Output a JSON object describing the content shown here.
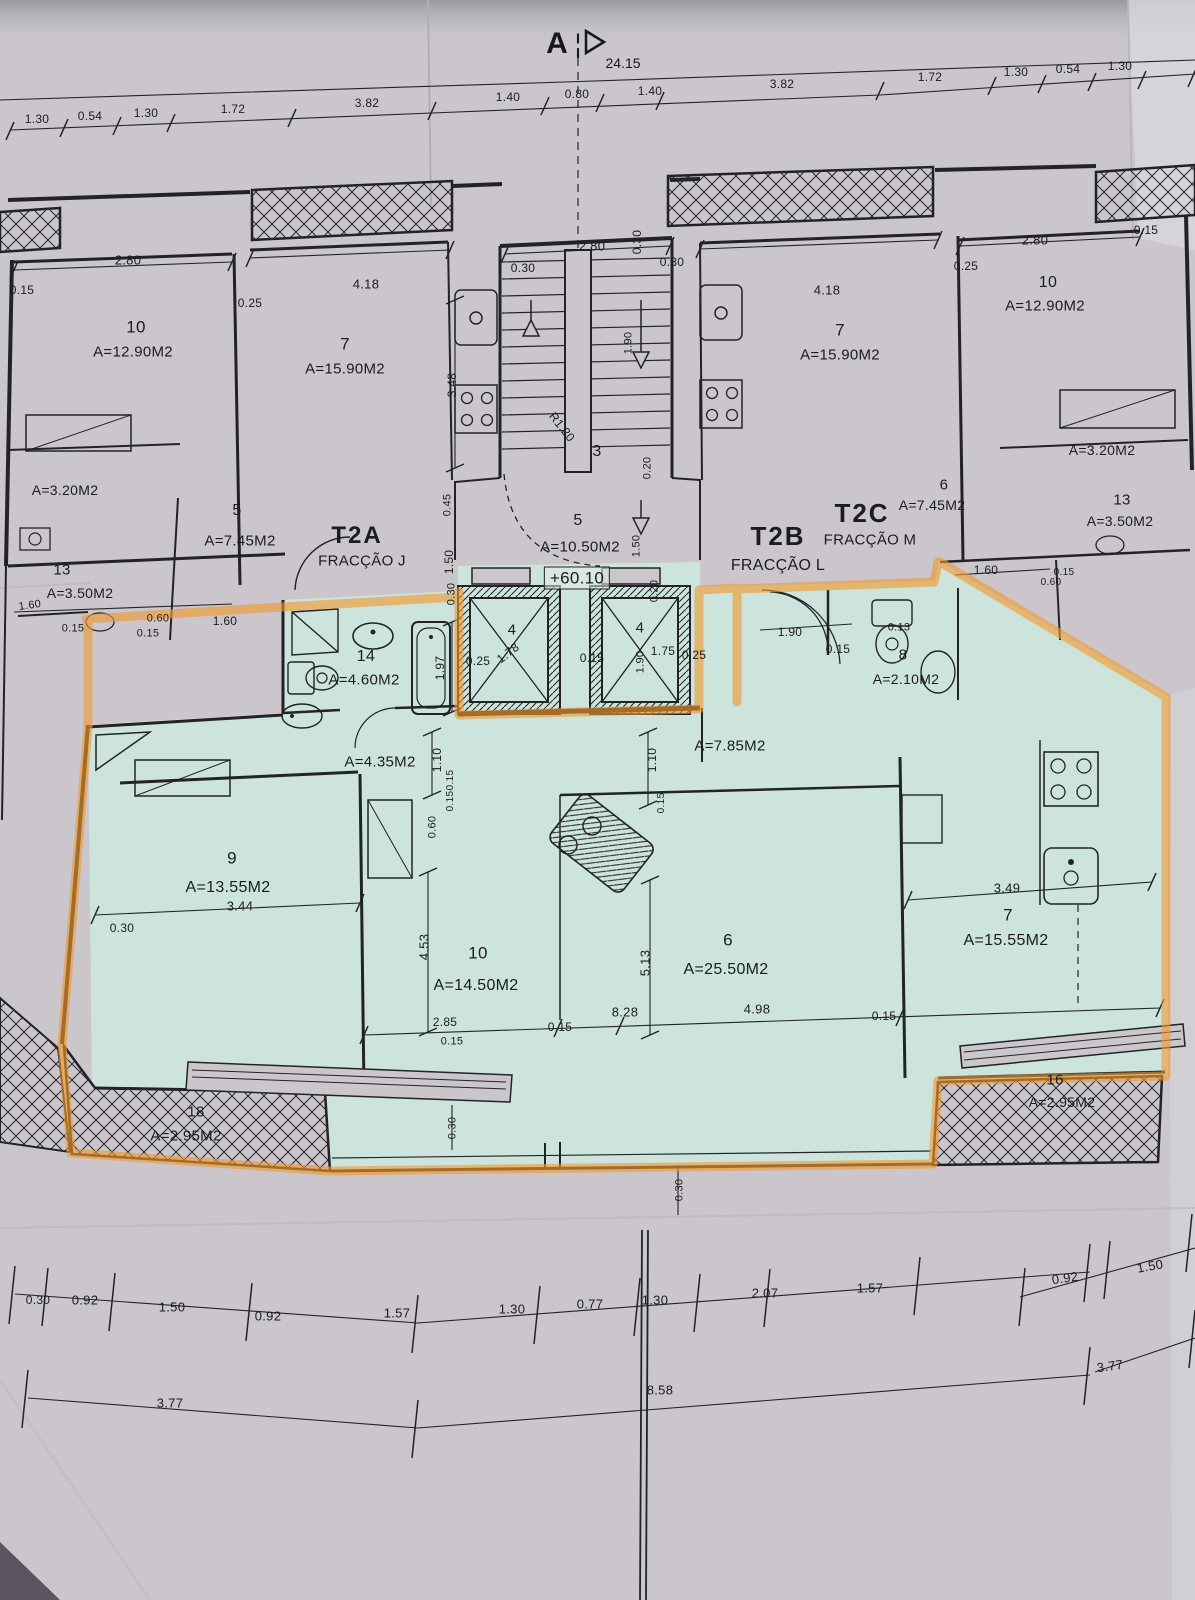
{
  "plan": {
    "section_marker": "A",
    "overall_dimension": "24.15",
    "level_mark": "+60.10",
    "fractions": [
      {
        "code": "T2A",
        "label": "FRACÇÃO J"
      },
      {
        "code": "T2B",
        "label": "FRACÇÃO L"
      },
      {
        "code": "T2C",
        "label": "FRACÇÃO M"
      }
    ],
    "colors": {
      "paper": "#cac6cc",
      "highlight_fill": "#cde4dc",
      "highlighter_orange": "#f0992f",
      "ink": "#232327"
    },
    "labels": [
      {
        "t": "1.30",
        "x": 37,
        "y": 119,
        "s": 12
      },
      {
        "t": "0.54",
        "x": 90,
        "y": 116,
        "s": 12
      },
      {
        "t": "1.30",
        "x": 146,
        "y": 113,
        "s": 12
      },
      {
        "t": "1.72",
        "x": 233,
        "y": 109,
        "s": 12
      },
      {
        "t": "3.82",
        "x": 367,
        "y": 103,
        "s": 12
      },
      {
        "t": "1.40",
        "x": 508,
        "y": 97,
        "s": 12
      },
      {
        "t": "0.80",
        "x": 577,
        "y": 94,
        "s": 12
      },
      {
        "t": "1.40",
        "x": 650,
        "y": 91,
        "s": 12
      },
      {
        "t": "3.82",
        "x": 782,
        "y": 84,
        "s": 12
      },
      {
        "t": "1.72",
        "x": 930,
        "y": 77,
        "s": 12
      },
      {
        "t": "1.30",
        "x": 1016,
        "y": 72,
        "s": 12
      },
      {
        "t": "0.54",
        "x": 1068,
        "y": 69,
        "s": 12
      },
      {
        "t": "1.30",
        "x": 1120,
        "y": 66,
        "s": 12
      },
      {
        "t": "0.15",
        "x": 22,
        "y": 290,
        "s": 12
      },
      {
        "t": "2.80",
        "x": 128,
        "y": 260,
        "s": 13
      },
      {
        "t": "10",
        "x": 136,
        "y": 327,
        "s": 17,
        "n": "room-number"
      },
      {
        "t": "A=12.90M2",
        "x": 133,
        "y": 352,
        "s": 15,
        "n": "room-area"
      },
      {
        "t": "0.25",
        "x": 250,
        "y": 303,
        "s": 12
      },
      {
        "t": "4.18",
        "x": 366,
        "y": 284,
        "s": 13
      },
      {
        "t": "7",
        "x": 345,
        "y": 344,
        "s": 17,
        "n": "room-number"
      },
      {
        "t": "A=15.90M2",
        "x": 345,
        "y": 369,
        "s": 15,
        "n": "room-area"
      },
      {
        "t": "3.48",
        "x": 452,
        "y": 385,
        "r": -90,
        "s": 12
      },
      {
        "t": "A=3.20M2",
        "x": 65,
        "y": 490,
        "s": 14,
        "n": "room-area"
      },
      {
        "t": "5",
        "x": 237,
        "y": 511,
        "s": 16,
        "n": "room-number"
      },
      {
        "t": "A=7.45M2",
        "x": 240,
        "y": 541,
        "s": 15,
        "n": "room-area"
      },
      {
        "t": "13",
        "x": 62,
        "y": 570,
        "s": 15,
        "n": "room-number"
      },
      {
        "t": "A=3.50M2",
        "x": 80,
        "y": 593,
        "s": 14,
        "n": "room-area"
      },
      {
        "t": "1.60",
        "x": 30,
        "y": 606,
        "s": 11,
        "r": -8
      },
      {
        "t": "0.60",
        "x": 158,
        "y": 619,
        "s": 11
      },
      {
        "t": "0.15",
        "x": 148,
        "y": 634,
        "s": 11
      },
      {
        "t": "1.60",
        "x": 225,
        "y": 621,
        "s": 12
      },
      {
        "t": "0.15",
        "x": 73,
        "y": 629,
        "s": 11
      },
      {
        "t": "T2A",
        "x": 357,
        "y": 536,
        "s": 24,
        "b": 1,
        "n": "unit-code-t2a"
      },
      {
        "t": "FRACÇÃO J",
        "x": 362,
        "y": 561,
        "s": 15,
        "n": "fraction-j-label"
      },
      {
        "t": "0.45",
        "x": 448,
        "y": 505,
        "r": -90,
        "s": 11
      },
      {
        "t": "1.50",
        "x": 449,
        "y": 562,
        "r": -90,
        "s": 12
      },
      {
        "t": "0.30",
        "x": 452,
        "y": 594,
        "r": -90,
        "s": 11
      },
      {
        "t": "2.80",
        "x": 592,
        "y": 246,
        "s": 13
      },
      {
        "t": "0.30",
        "x": 523,
        "y": 268,
        "s": 12
      },
      {
        "t": "0.30",
        "x": 637,
        "y": 242,
        "r": -90,
        "s": 12
      },
      {
        "t": "0.30",
        "x": 672,
        "y": 262,
        "s": 12
      },
      {
        "t": "1.90",
        "x": 629,
        "y": 343,
        "r": -90,
        "s": 11
      },
      {
        "t": "R1.20",
        "x": 562,
        "y": 427,
        "r": 52,
        "s": 12,
        "n": "stair-radius-label"
      },
      {
        "t": "3",
        "x": 597,
        "y": 452,
        "s": 16,
        "n": "room-number"
      },
      {
        "t": "5",
        "x": 578,
        "y": 521,
        "s": 16,
        "n": "room-number"
      },
      {
        "t": "A=10.50M2",
        "x": 580,
        "y": 547,
        "s": 15,
        "n": "room-area"
      },
      {
        "t": "+60.10",
        "x": 577,
        "y": 578,
        "s": 17,
        "bx": 1,
        "n": "level-mark"
      },
      {
        "t": "1.50",
        "x": 637,
        "y": 546,
        "r": -90,
        "s": 11
      },
      {
        "t": "0.20",
        "x": 655,
        "y": 591,
        "r": -90,
        "s": 11
      },
      {
        "t": "0.20",
        "x": 648,
        "y": 468,
        "r": -90,
        "s": 11
      },
      {
        "t": "4",
        "x": 512,
        "y": 630,
        "s": 15,
        "n": "elevator-number"
      },
      {
        "t": "1.78",
        "x": 508,
        "y": 653,
        "r": -38,
        "s": 12
      },
      {
        "t": "4",
        "x": 640,
        "y": 628,
        "s": 15,
        "n": "elevator-number"
      },
      {
        "t": "1.75",
        "x": 663,
        "y": 651,
        "s": 12
      },
      {
        "t": "0.25",
        "x": 478,
        "y": 661,
        "s": 12
      },
      {
        "t": "0.15",
        "x": 592,
        "y": 658,
        "s": 12
      },
      {
        "t": "0.25",
        "x": 694,
        "y": 655,
        "s": 12
      },
      {
        "t": "1.90",
        "x": 641,
        "y": 662,
        "r": -90,
        "s": 11
      },
      {
        "t": "T2B",
        "x": 778,
        "y": 536,
        "s": 26,
        "b": 1,
        "n": "unit-code-t2b"
      },
      {
        "t": "FRACÇÃO L",
        "x": 778,
        "y": 566,
        "s": 16,
        "n": "fraction-l-label"
      },
      {
        "t": "T2C",
        "x": 862,
        "y": 513,
        "s": 26,
        "b": 1,
        "n": "unit-code-t2c"
      },
      {
        "t": "FRACÇÃO M",
        "x": 870,
        "y": 540,
        "s": 15,
        "n": "fraction-m-label"
      },
      {
        "t": "6",
        "x": 944,
        "y": 485,
        "s": 15,
        "n": "room-number"
      },
      {
        "t": "A=7.45M2",
        "x": 932,
        "y": 505,
        "s": 14,
        "n": "room-area"
      },
      {
        "t": "1.90",
        "x": 790,
        "y": 632,
        "s": 12
      },
      {
        "t": "0.15",
        "x": 838,
        "y": 649,
        "s": 12
      },
      {
        "t": "0.13",
        "x": 899,
        "y": 628,
        "s": 11
      },
      {
        "t": "8",
        "x": 903,
        "y": 655,
        "s": 15,
        "n": "room-number"
      },
      {
        "t": "A=2.10M2",
        "x": 906,
        "y": 679,
        "s": 14,
        "n": "room-area"
      },
      {
        "t": "1.60",
        "x": 986,
        "y": 570,
        "s": 12
      },
      {
        "t": "0.15",
        "x": 1064,
        "y": 573,
        "s": 10
      },
      {
        "t": "0.60",
        "x": 1051,
        "y": 583,
        "s": 10
      },
      {
        "t": "2.80",
        "x": 1035,
        "y": 240,
        "s": 13
      },
      {
        "t": "0.15",
        "x": 1146,
        "y": 230,
        "s": 12
      },
      {
        "t": "10",
        "x": 1048,
        "y": 283,
        "s": 16,
        "n": "room-number"
      },
      {
        "t": "A=12.90M2",
        "x": 1045,
        "y": 306,
        "s": 15,
        "n": "room-area"
      },
      {
        "t": "0.25",
        "x": 966,
        "y": 266,
        "s": 12
      },
      {
        "t": "4.18",
        "x": 827,
        "y": 290,
        "s": 13
      },
      {
        "t": "7",
        "x": 840,
        "y": 330,
        "s": 17,
        "n": "room-number"
      },
      {
        "t": "A=15.90M2",
        "x": 840,
        "y": 355,
        "s": 15,
        "n": "room-area"
      },
      {
        "t": "A=3.20M2",
        "x": 1102,
        "y": 450,
        "s": 14,
        "n": "room-area"
      },
      {
        "t": "13",
        "x": 1122,
        "y": 500,
        "s": 15,
        "n": "room-number"
      },
      {
        "t": "A=3.50M2",
        "x": 1120,
        "y": 521,
        "s": 14,
        "n": "room-area"
      },
      {
        "t": "14",
        "x": 366,
        "y": 657,
        "s": 16,
        "n": "room-number"
      },
      {
        "t": "A=4.60M2",
        "x": 364,
        "y": 680,
        "s": 15,
        "n": "room-area"
      },
      {
        "t": "1.97",
        "x": 440,
        "y": 668,
        "r": -90,
        "s": 12
      },
      {
        "t": "A=4.35M2",
        "x": 380,
        "y": 762,
        "s": 15,
        "n": "room-area"
      },
      {
        "t": "1.10",
        "x": 437,
        "y": 760,
        "r": -90,
        "s": 12
      },
      {
        "t": "0.15",
        "x": 451,
        "y": 780,
        "r": -90,
        "s": 10
      },
      {
        "t": "0.15",
        "x": 451,
        "y": 801,
        "r": -90,
        "s": 10
      },
      {
        "t": "0.60",
        "x": 433,
        "y": 827,
        "r": -90,
        "s": 11
      },
      {
        "t": "A=7.85M2",
        "x": 730,
        "y": 746,
        "s": 15,
        "n": "room-area"
      },
      {
        "t": "1.10",
        "x": 652,
        "y": 760,
        "r": -90,
        "s": 12
      },
      {
        "t": "0.15",
        "x": 662,
        "y": 803,
        "r": -90,
        "s": 10
      },
      {
        "t": "9",
        "x": 232,
        "y": 858,
        "s": 17,
        "n": "room-number"
      },
      {
        "t": "A=13.55M2",
        "x": 228,
        "y": 888,
        "s": 16,
        "n": "room-area"
      },
      {
        "t": "3.44",
        "x": 240,
        "y": 906,
        "s": 13
      },
      {
        "t": "0.30",
        "x": 122,
        "y": 928,
        "s": 12
      },
      {
        "t": "4.53",
        "x": 424,
        "y": 947,
        "r": -90,
        "s": 13
      },
      {
        "t": "10",
        "x": 478,
        "y": 953,
        "s": 17,
        "n": "room-number"
      },
      {
        "t": "A=14.50M2",
        "x": 476,
        "y": 986,
        "s": 16,
        "n": "room-area"
      },
      {
        "t": "2.85",
        "x": 445,
        "y": 1022,
        "s": 12
      },
      {
        "t": "0.15",
        "x": 452,
        "y": 1042,
        "s": 11
      },
      {
        "t": "0.15",
        "x": 560,
        "y": 1027,
        "s": 12
      },
      {
        "t": "5.13",
        "x": 645,
        "y": 963,
        "r": -90,
        "s": 13
      },
      {
        "t": "6",
        "x": 728,
        "y": 940,
        "s": 17,
        "n": "room-number"
      },
      {
        "t": "A=25.50M2",
        "x": 726,
        "y": 970,
        "s": 16,
        "n": "room-area"
      },
      {
        "t": "8.28",
        "x": 625,
        "y": 1012,
        "s": 13
      },
      {
        "t": "4.98",
        "x": 757,
        "y": 1009,
        "s": 13
      },
      {
        "t": "0.15",
        "x": 884,
        "y": 1016,
        "s": 12
      },
      {
        "t": "3.49",
        "x": 1007,
        "y": 888,
        "s": 13
      },
      {
        "t": "7",
        "x": 1008,
        "y": 915,
        "s": 17,
        "n": "room-number"
      },
      {
        "t": "A=15.55M2",
        "x": 1006,
        "y": 941,
        "s": 16,
        "n": "room-area"
      },
      {
        "t": "18",
        "x": 196,
        "y": 1112,
        "s": 15,
        "n": "room-number"
      },
      {
        "t": "A=2.95M2",
        "x": 186,
        "y": 1136,
        "s": 15,
        "n": "room-area"
      },
      {
        "t": "16",
        "x": 1055,
        "y": 1080,
        "s": 15,
        "n": "room-number"
      },
      {
        "t": "A=2.95M2",
        "x": 1062,
        "y": 1102,
        "s": 14,
        "n": "room-area"
      },
      {
        "t": "0.30",
        "x": 453,
        "y": 1128,
        "r": -90,
        "s": 11
      },
      {
        "t": "0.30",
        "x": 680,
        "y": 1190,
        "r": -90,
        "s": 11
      },
      {
        "t": "0.30",
        "x": 38,
        "y": 1300,
        "s": 12
      },
      {
        "t": "0.92",
        "x": 85,
        "y": 1300,
        "s": 13
      },
      {
        "t": "1.50",
        "x": 172,
        "y": 1307,
        "s": 13
      },
      {
        "t": "0.92",
        "x": 268,
        "y": 1316,
        "s": 13
      },
      {
        "t": "1.57",
        "x": 397,
        "y": 1313,
        "s": 13
      },
      {
        "t": "1.30",
        "x": 512,
        "y": 1309,
        "s": 13
      },
      {
        "t": "0.77",
        "x": 590,
        "y": 1304,
        "s": 13
      },
      {
        "t": "1.30",
        "x": 655,
        "y": 1300,
        "s": 13
      },
      {
        "t": "2.07",
        "x": 765,
        "y": 1293,
        "s": 13
      },
      {
        "t": "1.57",
        "x": 870,
        "y": 1288,
        "s": 13
      },
      {
        "t": "0.92",
        "x": 1065,
        "y": 1278,
        "s": 13,
        "r": -8
      },
      {
        "t": "1.50",
        "x": 1150,
        "y": 1266,
        "s": 13,
        "r": -10
      },
      {
        "t": "3.77",
        "x": 170,
        "y": 1403,
        "s": 13
      },
      {
        "t": "8.58",
        "x": 660,
        "y": 1390,
        "s": 13
      },
      {
        "t": "3.77",
        "x": 1110,
        "y": 1366,
        "s": 13,
        "r": -8
      }
    ]
  }
}
